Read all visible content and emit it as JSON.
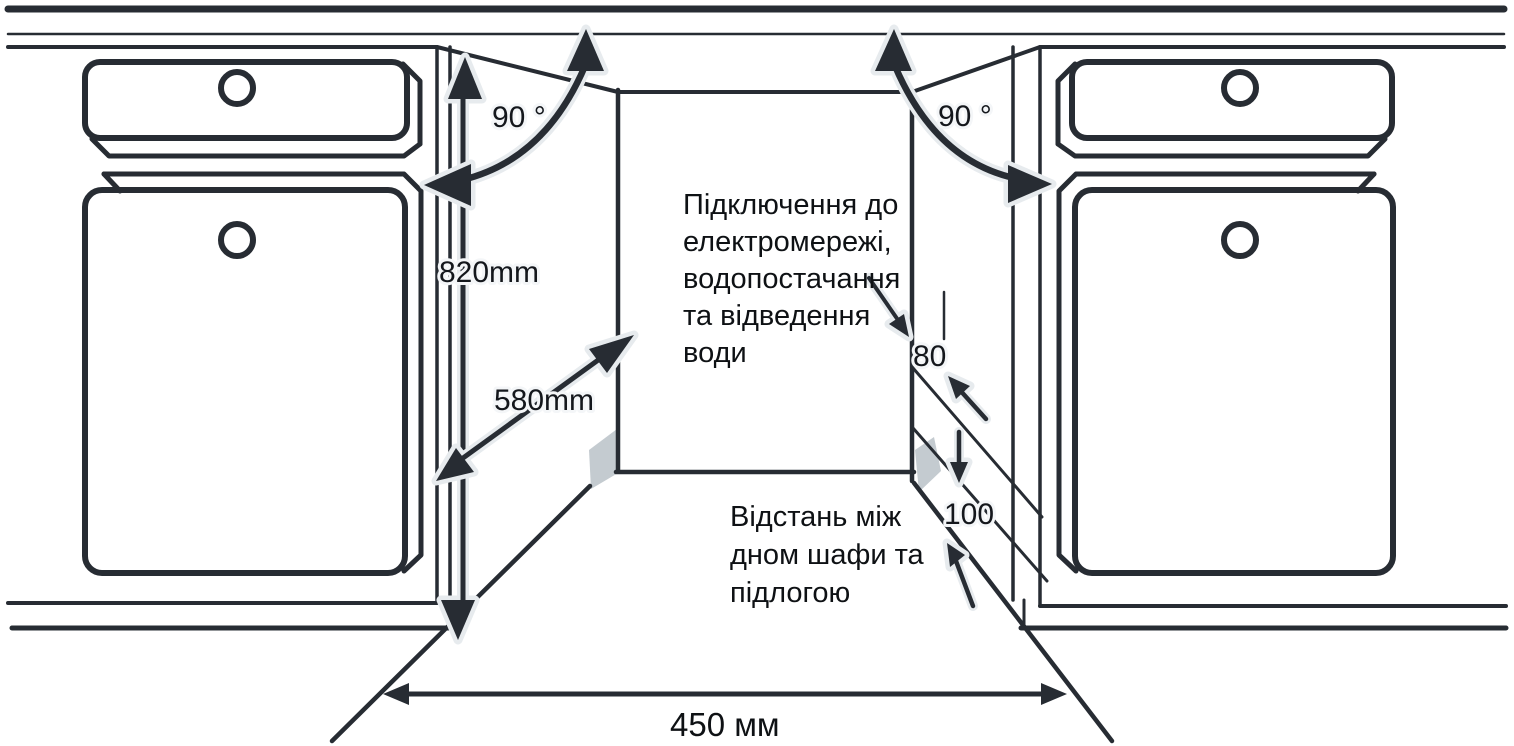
{
  "diagram": {
    "title": "built-in-dishwasher-installation-niche",
    "labels": {
      "angle": "90 °",
      "niche_height": "820mm",
      "niche_depth": "580mm",
      "niche_width": "450 мм",
      "hose_gap": "80",
      "plinth_gap": "100"
    },
    "annotations": {
      "connection": {
        "lines": [
          "Підключення до",
          "електромережі,",
          "водопостачання",
          "та відведення",
          "води"
        ]
      },
      "floor": {
        "lines": [
          "Відстань між",
          "дном шафи та",
          "підлогою"
        ]
      }
    },
    "colors": {
      "line": "#272c33",
      "text": "#0e1114",
      "halo": "#e7ebee",
      "shade": "#c4cbd0",
      "background": "#ffffff"
    }
  }
}
